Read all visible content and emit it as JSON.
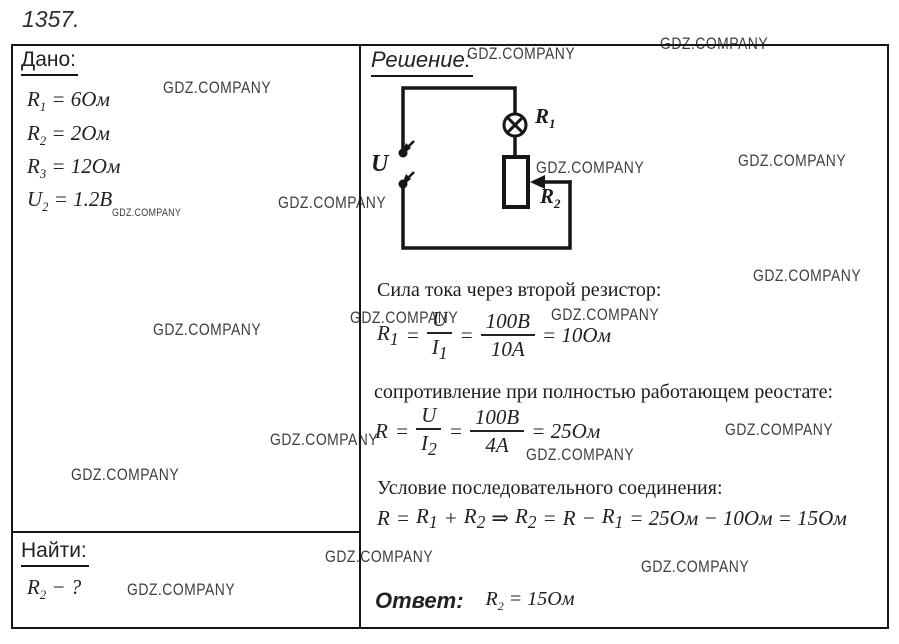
{
  "problem": {
    "number": "1357."
  },
  "watermark": {
    "text": "GDZ.COMPANY"
  },
  "given": {
    "header": "Дано:",
    "items": [
      {
        "sym": "R",
        "sub": "1",
        "value": "= 6Ом"
      },
      {
        "sym": "R",
        "sub": "2",
        "value": "= 2Ом"
      },
      {
        "sym": "R",
        "sub": "3",
        "value": "= 12Ом"
      },
      {
        "sym": "U",
        "sub": "2",
        "value": "= 1.2В"
      }
    ]
  },
  "find": {
    "header": "Найти:",
    "sym": "R",
    "sub": "2",
    "value": "− ?"
  },
  "solution": {
    "header": "Решение:",
    "circuit": {
      "source_label": "U",
      "lamp_label": "R",
      "lamp_sub": "1",
      "rheostat_label": "R",
      "rheostat_sub": "2"
    },
    "step1_text": "Сила тока через второй резистор:",
    "f1": {
      "lhs": "R",
      "lhs_sub": "1",
      "eq1": "=",
      "num1": "U",
      "den1": "I",
      "den1_sub": "1",
      "eq2": "=",
      "num2": "100В",
      "den2": "10А",
      "result": "= 10Ом"
    },
    "step2_text": "сопротивление при полностью работающем реостате:",
    "f2": {
      "lhs": "R",
      "eq1": "=",
      "num1": "U",
      "den1": "I",
      "den1_sub": "2",
      "eq2": "=",
      "num2": "100В",
      "den2": "4А",
      "result": "= 25Ом"
    },
    "step3_text": "Условие последовательного соединения:",
    "f3": {
      "t1": "R",
      "t2": "=",
      "t3": "R",
      "t3_sub": "1",
      "t4": "+",
      "t5": "R",
      "t5_sub": "2",
      "t6": "⇒",
      "t7": "R",
      "t7_sub": "2",
      "t8": "=",
      "t9": "R",
      "t10": "−",
      "t11": "R",
      "t11_sub": "1",
      "t12": "= 25Ом − 10Ом = 15Ом"
    },
    "answer_label": "Ответ:",
    "answer": {
      "sym": "R",
      "sub": "2",
      "value": "= 15Ом"
    }
  }
}
